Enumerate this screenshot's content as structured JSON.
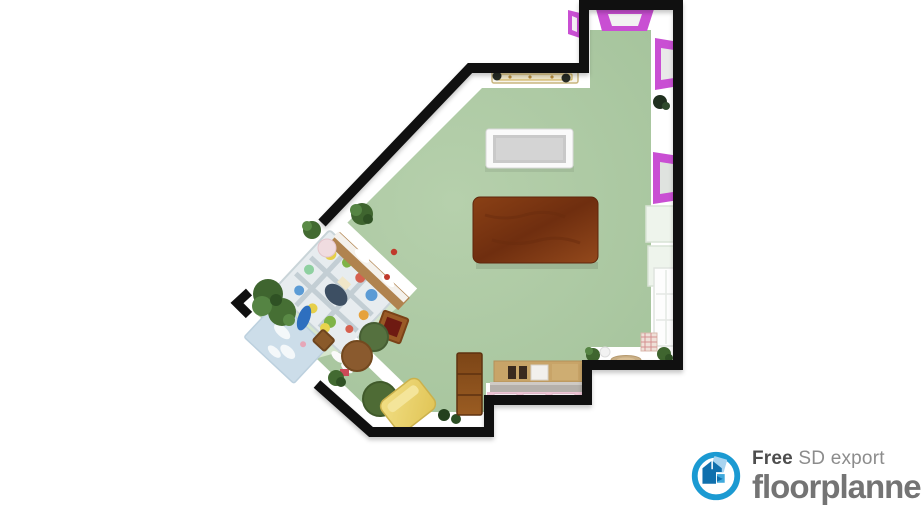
{
  "app": {
    "name": "floorplanner",
    "view": "3D top-down floor plan export"
  },
  "watermark": {
    "free_label": "Free",
    "plan_label": "SD export",
    "brand": "floorplanner"
  },
  "colors": {
    "accent_magenta": "#c94fd3",
    "floor_green": "#a9c7a2",
    "nook_floor": "#d5e6cd",
    "wall_black": "#101010",
    "wood_dark": "#7a3a17",
    "wood_tan": "#c8a468",
    "bench_yellow": "#e9d069",
    "mat_pink": "#ecc3d4",
    "logo_blue": "#1b9ad2",
    "logo_blue_dark": "#1070ad",
    "text_dark": "#4d4d4d",
    "text_gray": "#8c8c8c",
    "brand_gray": "#747474"
  },
  "floorplan": {
    "rooms": [
      {
        "name": "main-room",
        "floor_color": "#a9c7a2"
      },
      {
        "name": "play-nook",
        "floor_color": "#d5e6cd"
      }
    ],
    "windows": [
      {
        "name": "top-window",
        "color": "#c94fd3"
      },
      {
        "name": "side-window-upper",
        "color": "#c94fd3"
      },
      {
        "name": "side-window-lower",
        "color": "#c94fd3"
      },
      {
        "name": "side-window-sliver",
        "color": "#c94fd3"
      },
      {
        "name": "glass-door",
        "color": "#f2f6f0"
      }
    ],
    "furniture": [
      "white-open-table",
      "wood-dining-table",
      "wall-shelf-tray",
      "kids-playmat",
      "pale-blue-rug",
      "toy-shelf-bench",
      "pouf-green",
      "pouf-brown",
      "wood-crate",
      "yellow-bench",
      "green-armchair",
      "tall-wood-cabinet",
      "sideboard-changing-table",
      "pink-changing-mats",
      "round-rug",
      "storage-box",
      "potted-plants",
      "toy-blue",
      "toy-yellow",
      "square-pouf",
      "pink-ball"
    ]
  }
}
